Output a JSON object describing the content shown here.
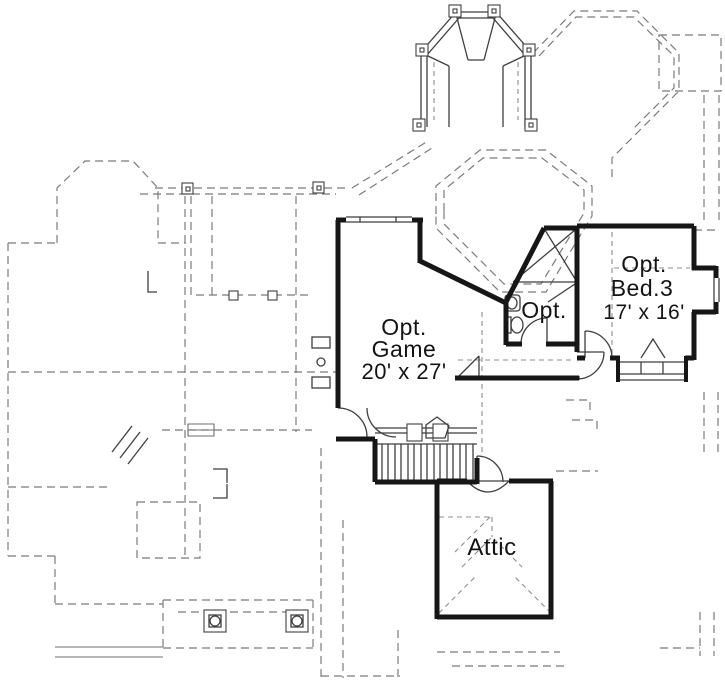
{
  "plan": {
    "type": "floor-plan",
    "background": "#ffffff",
    "colors": {
      "walls": "#161616",
      "thin_lines": "#3f3f3f",
      "lower_floor_dashed": "#7b7b7b",
      "text": "#141414"
    },
    "rooms": {
      "game": {
        "label_line1": "Opt.",
        "label_line2": "Game",
        "dimensions": "20' x 27'"
      },
      "bath": {
        "label": "Opt."
      },
      "bed3": {
        "label_line1": "Opt.",
        "label_line2": "Bed.3",
        "dimensions": "17' x 16'"
      },
      "attic": {
        "label": "Attic"
      }
    }
  }
}
